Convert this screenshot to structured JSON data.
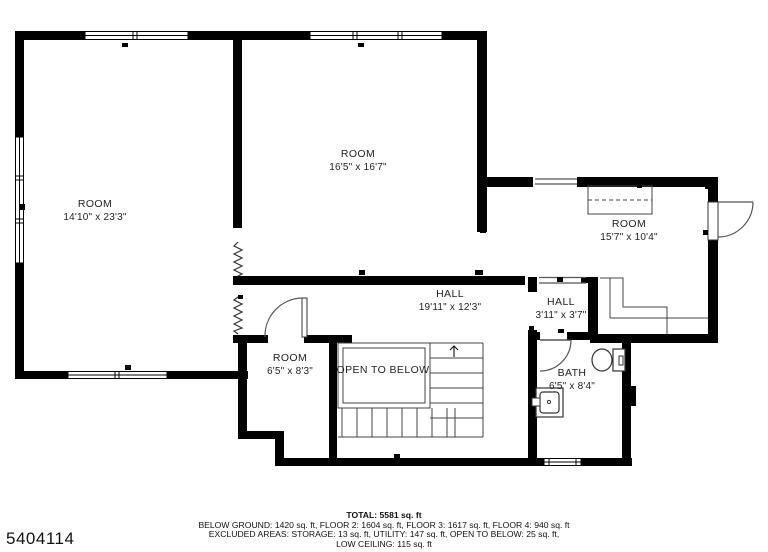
{
  "plan": {
    "rooms": [
      {
        "name": "ROOM",
        "dims": "14'10\" x 23'3\""
      },
      {
        "name": "ROOM",
        "dims": "16'5\" x 16'7\""
      },
      {
        "name": "ROOM",
        "dims": "15'7\" x 10'4\""
      },
      {
        "name": "HALL",
        "dims": "19'11\" x 12'3\""
      },
      {
        "name": "HALL",
        "dims": "3'11\" x 3'7\""
      },
      {
        "name": "ROOM",
        "dims": "6'5\" x 8'3\""
      },
      {
        "name": "BATH",
        "dims": "6'5\" x 8'4\""
      }
    ],
    "annotations": {
      "open_to_below": "OPEN TO BELOW"
    }
  },
  "footer": {
    "total": "TOTAL: 5581 sq. ft",
    "line2": "BELOW GROUND: 1420 sq. ft, FLOOR 2: 1604 sq. ft, FLOOR 3: 1617 sq. ft, FLOOR 4: 940 sq. ft",
    "line3": "EXCLUDED AREAS: STORAGE: 13 sq. ft, UTILITY: 147 sq. ft, OPEN TO BELOW: 25 sq. ft,",
    "line4": "LOW CEILING: 115 sq. ft"
  },
  "watermark": "5404114",
  "colors": {
    "wall": "#000000",
    "thin_line": "#4a4a4a",
    "text": "#1a1a1a",
    "background": "#ffffff"
  }
}
